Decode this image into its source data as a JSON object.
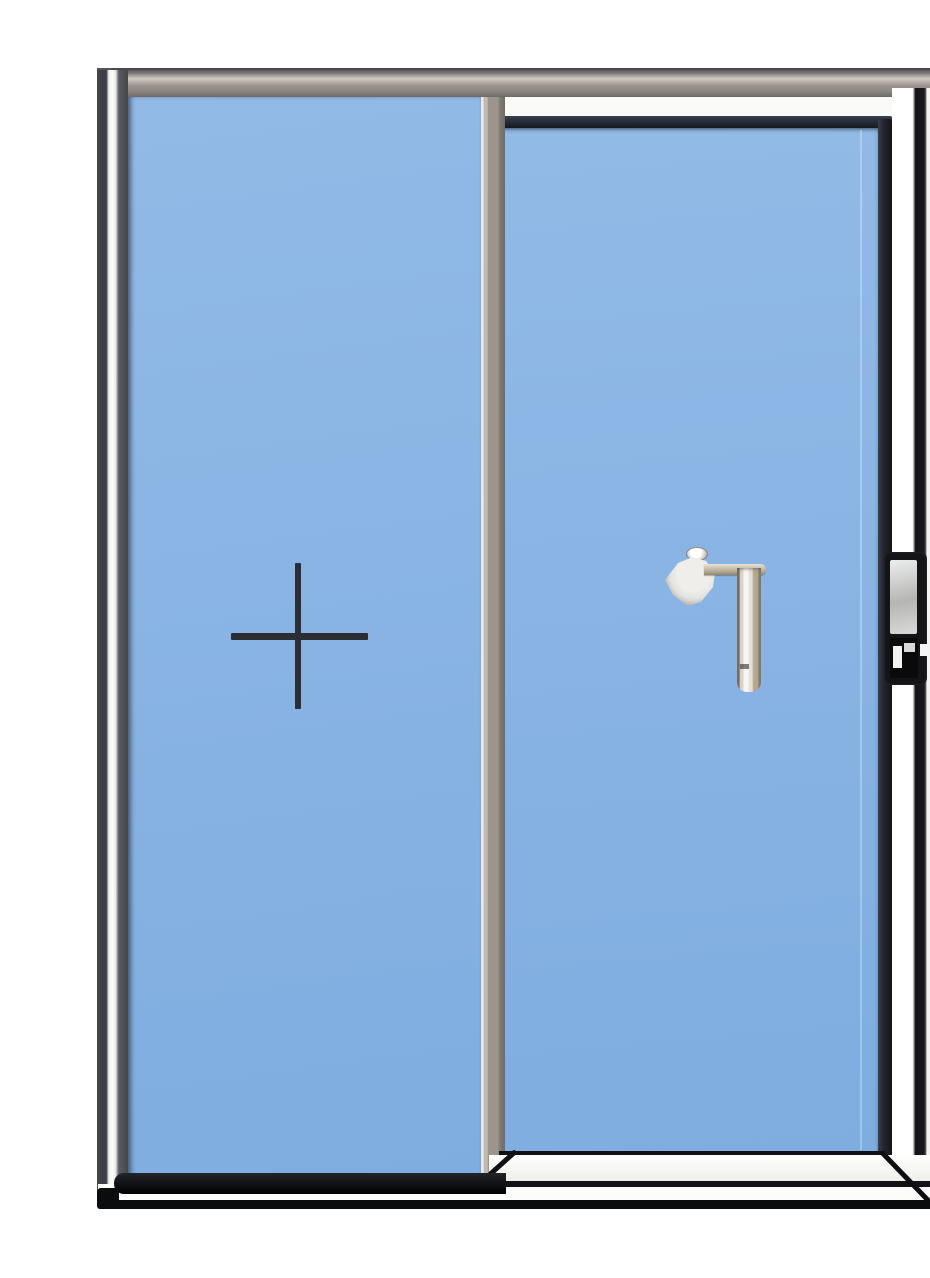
{
  "scene": {
    "description": "Product photograph of an aluminium-framed sliding patio door with two blue-glass panels on a plain white background",
    "subject": "sliding glass door",
    "panel_count": 2
  },
  "parts": {
    "outer_frame": "aluminium outer frame",
    "frame_top_rail": "outer frame top rail",
    "frame_left_jamb": "outer frame left jamb",
    "frame_right_jamb": "outer frame right jamb with lock recess",
    "frame_bottom_rail": "outer frame bottom rail",
    "left_panel": "fixed left glass panel",
    "glazing_cross": "cross-shaped glazing mark on left panel glass",
    "center_stile": "central meeting stile between panels",
    "right_panel": "sliding right glass panel",
    "right_panel_sill": "sliding panel bottom sill",
    "handle": "L-shaped interior pull handle on sliding panel",
    "lock": "recessed edge lock on right jamb"
  },
  "colors": {
    "background": "#ffffff",
    "glass_top": "#92bae7",
    "glass_bottom": "#7fade0",
    "frame_metal": "#9b958c",
    "frame_metal_light": "#cfcac2",
    "frame_metal_dark": "#6e6a66",
    "frame_white": "#fafaf8",
    "frame_black": "#121316",
    "jamb_dark": "#44464c",
    "rail_dark": "#1a1f28",
    "stile_dark": "#23262e",
    "cross_dark": "#2b2f35",
    "handle_silver": "#efeeea",
    "handle_shadow": "#8d8577",
    "handle_bronze": "#b3a78f",
    "lock_black": "#141416",
    "lock_insert": "#d9dad8"
  }
}
